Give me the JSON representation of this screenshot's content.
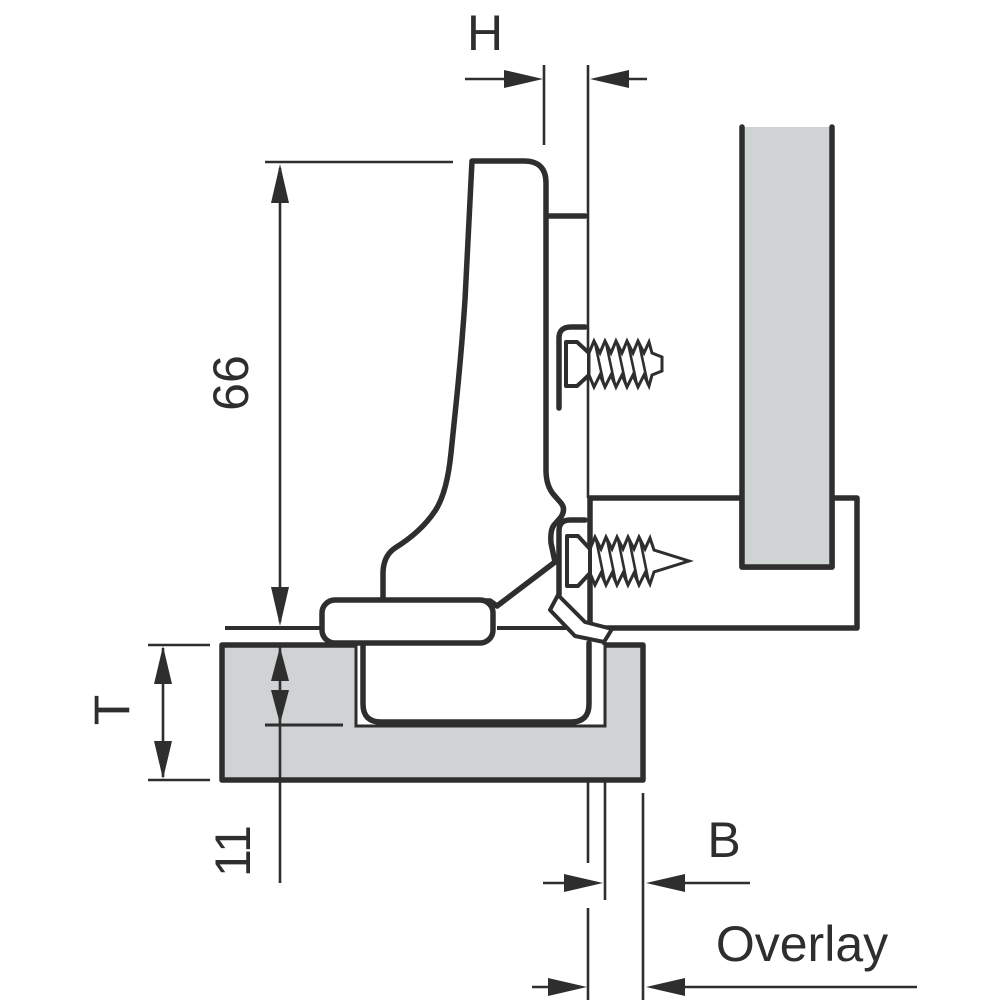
{
  "diagram": {
    "colors": {
      "line": "#2e2e2e",
      "panel_fill": "#d0d3d4",
      "background": "#ffffff"
    },
    "labels": {
      "h": "H",
      "height_66": "66",
      "door_thickness": "T",
      "drilling_depth_11": "11",
      "drilling_distance_b": "B",
      "overlay": "Overlay"
    }
  }
}
